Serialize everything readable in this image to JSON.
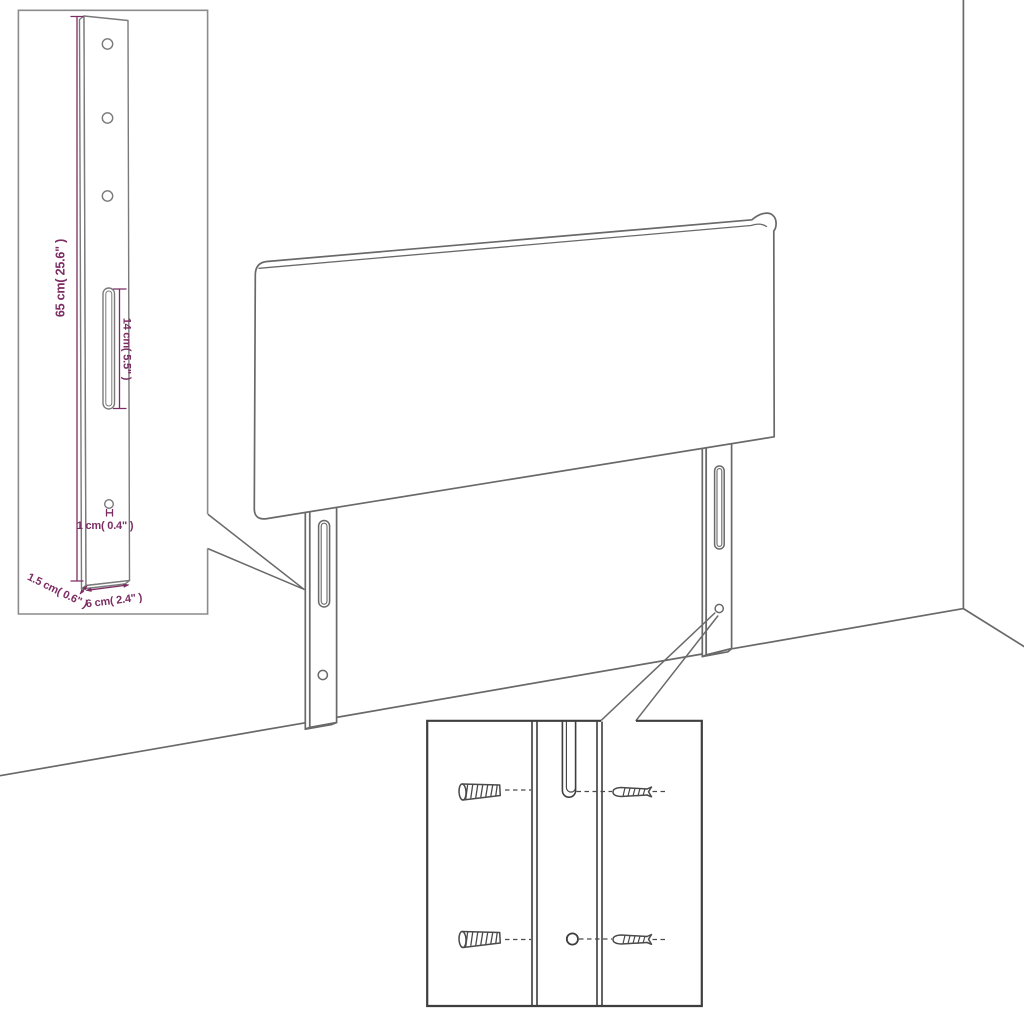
{
  "title": "Headboard with legs assembly diagram",
  "colors": {
    "outline_gray": "#696969",
    "dimension_purple": "#7c2d63",
    "inset_border_light": "#8c8c8c",
    "detail_dark": "#3e3e3e",
    "background": "#ffffff"
  },
  "leg_detail_inset": {
    "dim_height": "65 cm( 25.6\" )",
    "dim_slot_length": "14 cm( 5.5\" )",
    "dim_hole": "1 cm( 0.4\" )",
    "dim_thickness": "1.5 cm( 0.6\" )",
    "dim_width": "6 cm( 2.4\" )"
  }
}
